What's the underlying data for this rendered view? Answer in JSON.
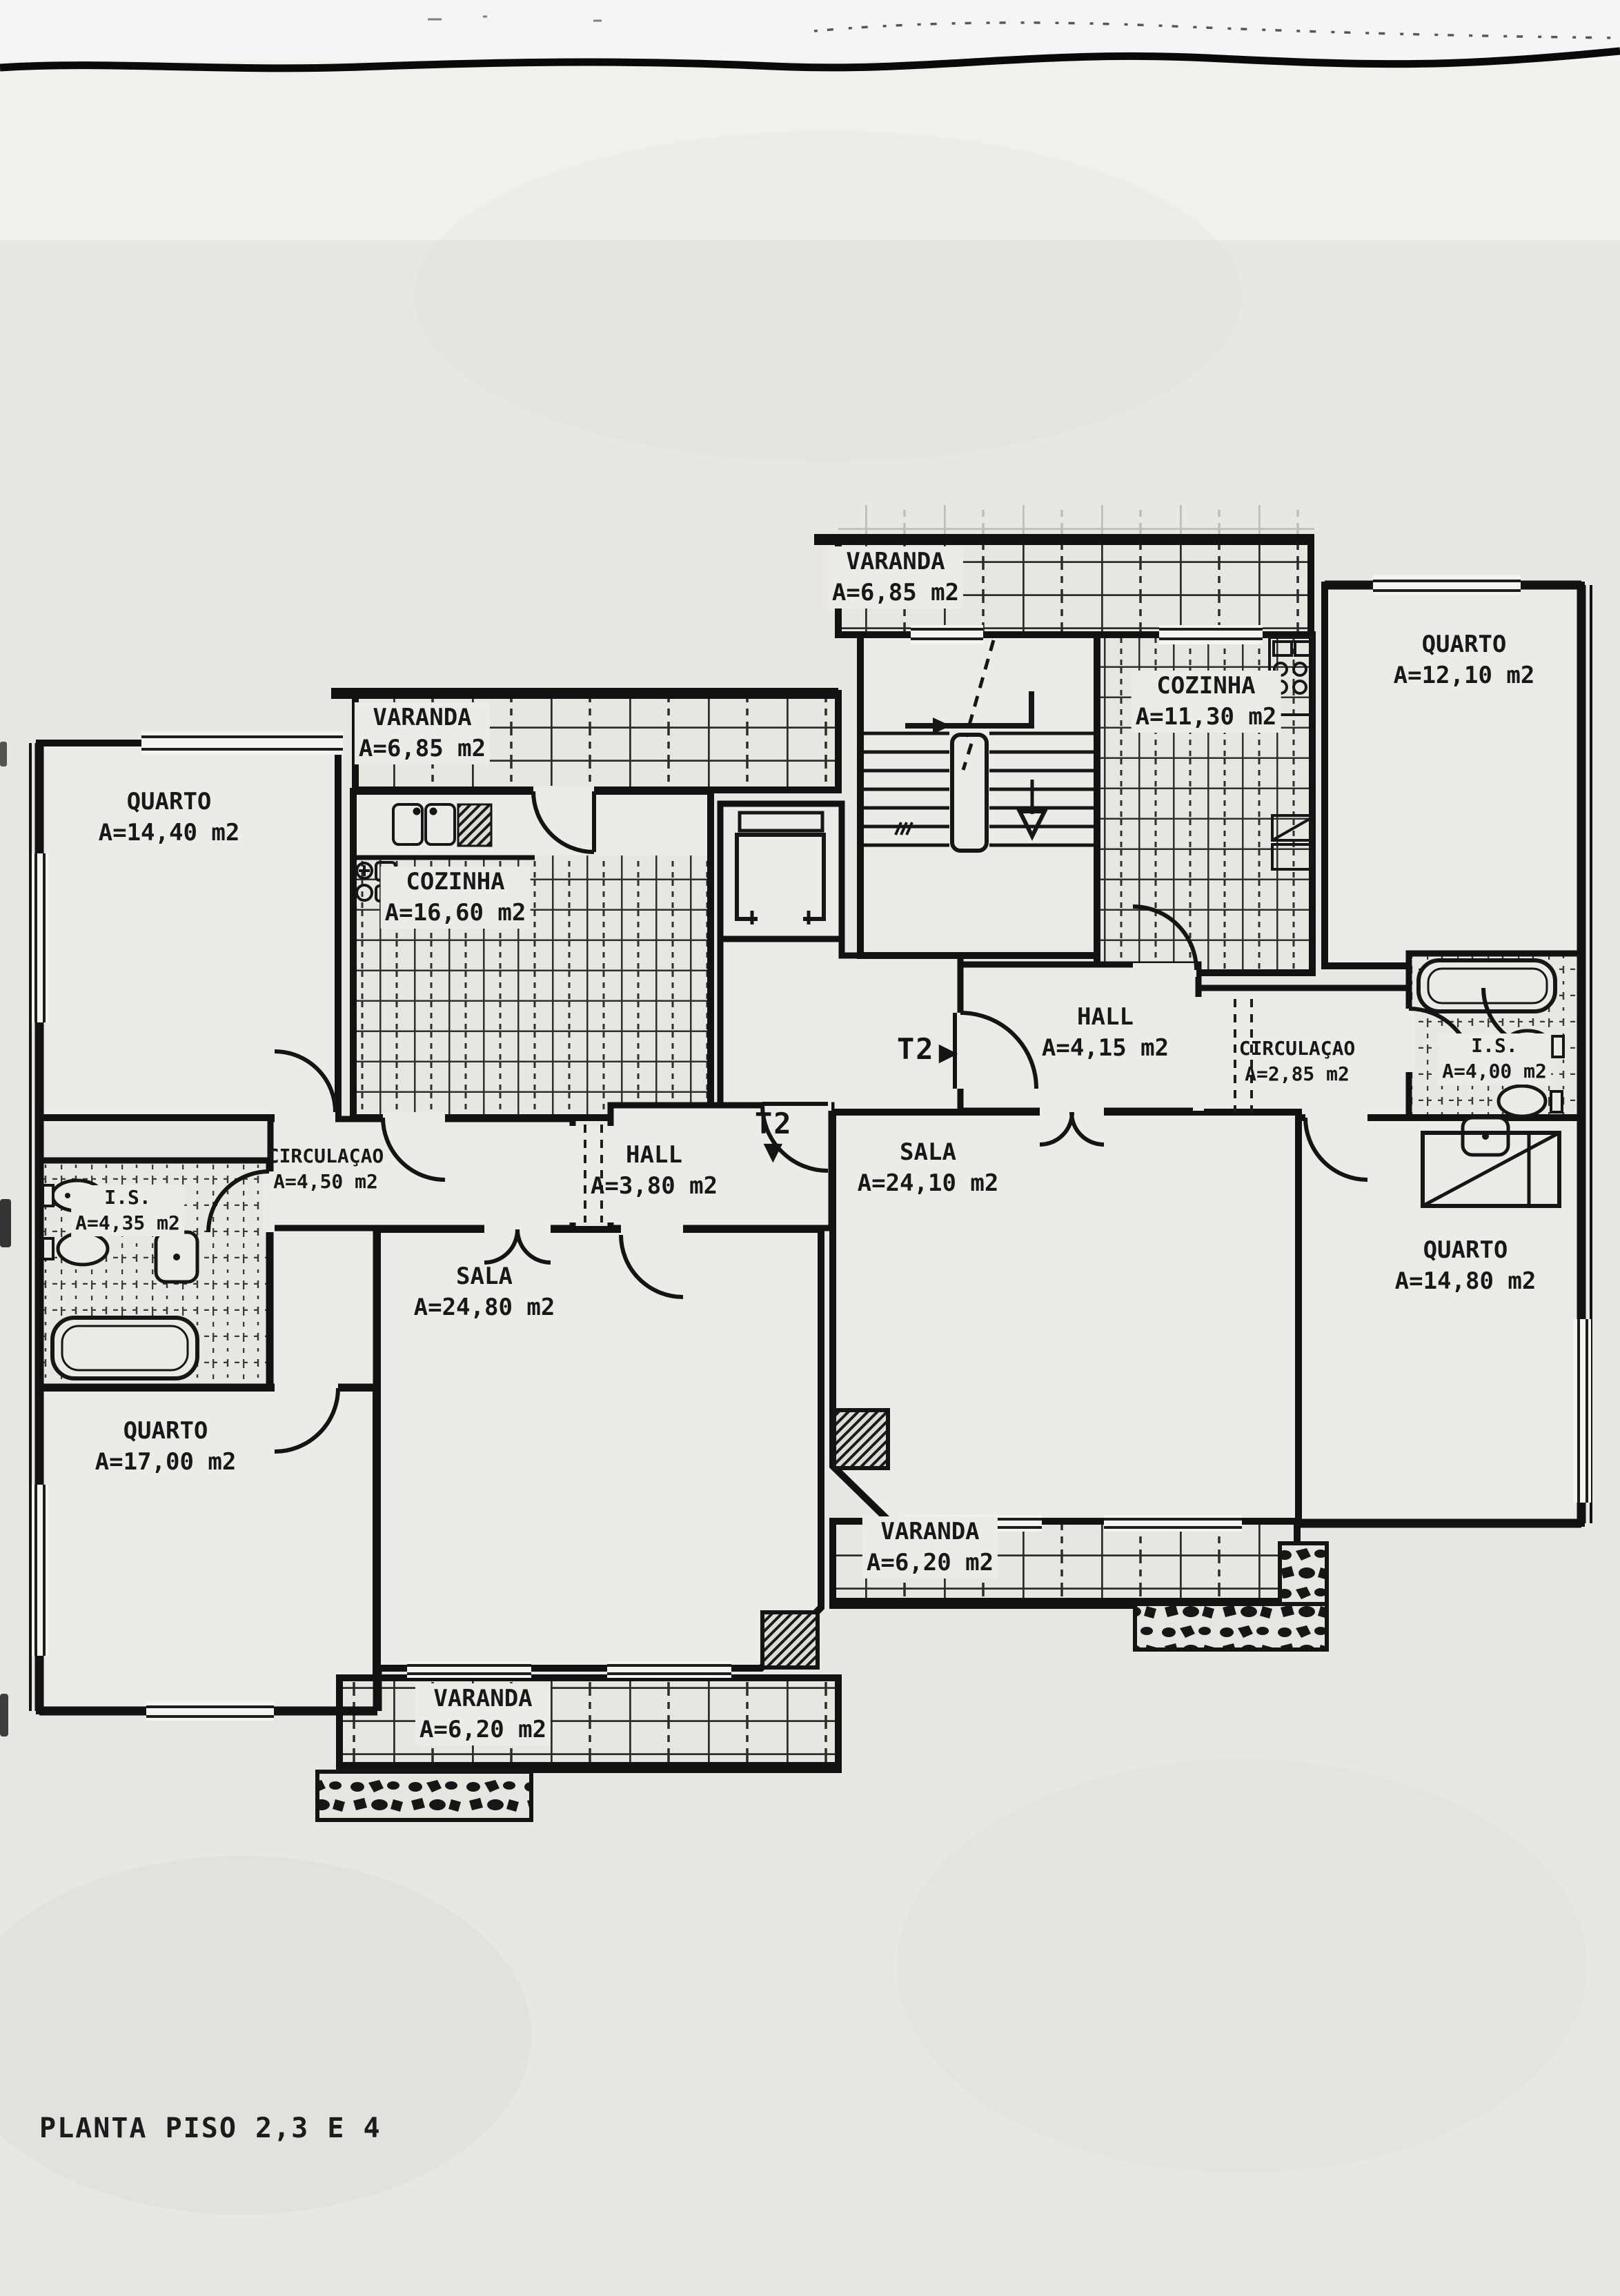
{
  "title": {
    "text": "PLANTA PISO 2,3 E 4"
  },
  "rooms": [
    {
      "name": "VARANDA",
      "area": "A=6,85 m2"
    },
    {
      "name": "COZINHA",
      "area": "A=11,30 m2"
    },
    {
      "name": "QUARTO",
      "area": "A=12,10 m2"
    },
    {
      "name": "VARANDA",
      "area": "A=6,85 m2"
    },
    {
      "name": "QUARTO",
      "area": "A=14,40 m2"
    },
    {
      "name": "COZINHA",
      "area": "A=16,60 m2"
    },
    {
      "name": "HALL",
      "area": "A=4,15 m2"
    },
    {
      "name": "CIRCULAÇAO",
      "area": "A=2,85 m2"
    },
    {
      "name": "I.S.",
      "area": "A=4,00 m2"
    },
    {
      "name": "CIRCULAÇAO",
      "area": "A=4,50 m2"
    },
    {
      "name": "HALL",
      "area": "A=3,80 m2"
    },
    {
      "name": "SALA",
      "area": "A=24,10 m2"
    },
    {
      "name": "I.S.",
      "area": "A=4,35 m2"
    },
    {
      "name": "SALA",
      "area": "A=24,80 m2"
    },
    {
      "name": "QUARTO",
      "area": "A=14,80 m2"
    },
    {
      "name": "QUARTO",
      "area": "A=17,00 m2"
    },
    {
      "name": "VARANDA",
      "area": "A=6,20 m2"
    },
    {
      "name": "VARANDA",
      "area": "A=6,20 m2"
    }
  ],
  "markers": {
    "t2_right": {
      "label": "T2",
      "arrow": "▶"
    },
    "t2_left": {
      "label": "T2",
      "arrow": "▼"
    }
  }
}
